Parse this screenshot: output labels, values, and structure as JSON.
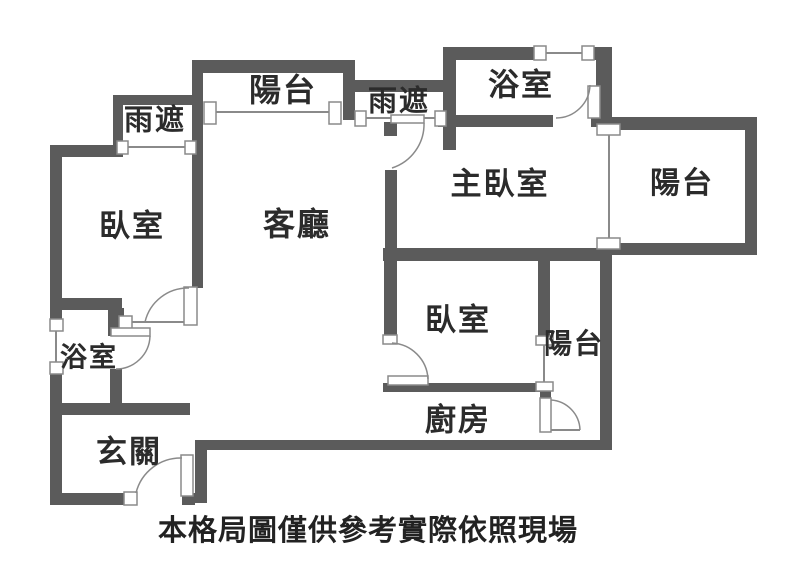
{
  "plan": {
    "caption": "本格局圖僅供參考實際依照現場",
    "rooms": {
      "canopy_top_left": "雨遮",
      "balcony_top": "陽台",
      "canopy_mid": "雨遮",
      "bath_top": "浴室",
      "master_bedroom": "主臥室",
      "balcony_right": "陽台",
      "bedroom_left": "臥室",
      "living": "客廳",
      "bedroom_mid": "臥室",
      "balcony_lower": "陽台",
      "bath_left": "浴室",
      "kitchen": "廚房",
      "entry": "玄關"
    },
    "colors": {
      "wall": "#5b5b5b",
      "line": "#8a8a8a",
      "text": "#2b2b2b"
    }
  }
}
